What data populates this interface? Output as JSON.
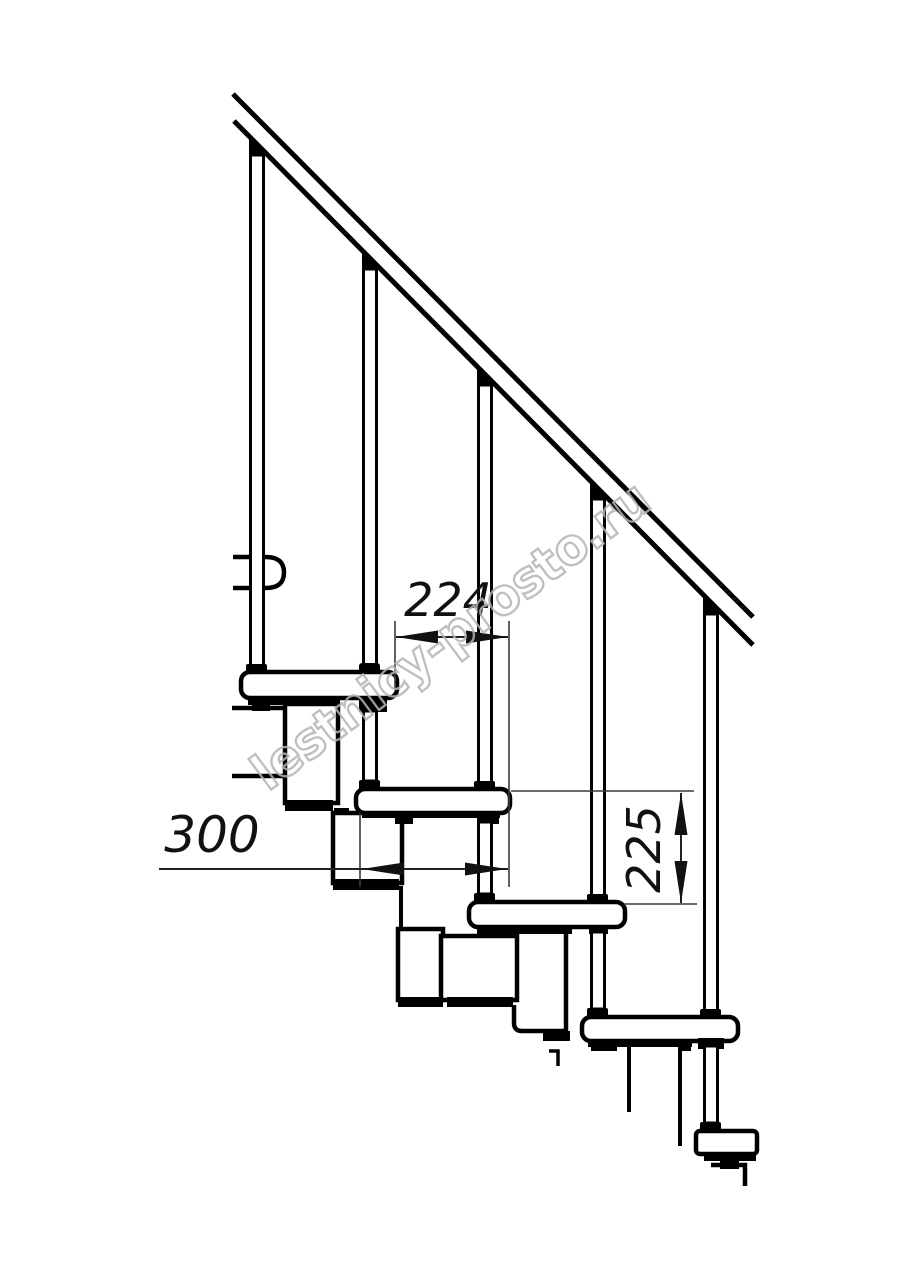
{
  "dimensions": {
    "step_run": "224",
    "tread_depth": "300",
    "step_rise": "225"
  },
  "watermark": {
    "text": "lestnicy-prosto.ru",
    "color": "#b4b4b4"
  },
  "colors": {
    "ink": "#000000",
    "dimension_ink": "#1a1a1a",
    "background": "#ffffff"
  }
}
